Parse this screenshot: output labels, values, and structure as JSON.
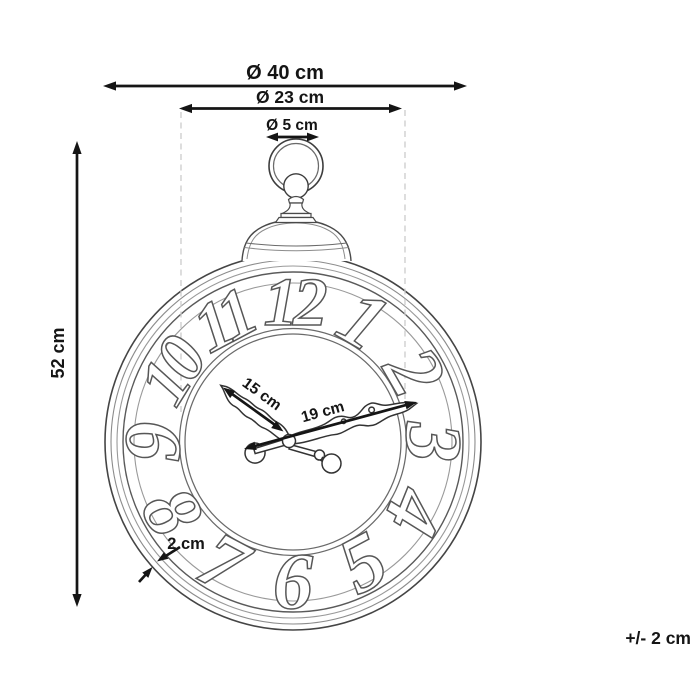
{
  "diagram": {
    "dimensions": {
      "outer_diameter": "Ø 40 cm",
      "dial_diameter": "Ø 23 cm",
      "ring_diameter": "Ø 5 cm",
      "height": "52 cm",
      "short_hand_length": "15 cm",
      "long_hand_length": "19 cm",
      "frame_depth": "2 cm",
      "tolerance": "+/- 2 cm"
    },
    "numerals": [
      "12",
      "1",
      "2",
      "3",
      "4",
      "5",
      "6",
      "7",
      "8",
      "9",
      "10",
      "11"
    ],
    "colors": {
      "ink": "#151515",
      "line_art": "#4a4a4a",
      "dashed_guide": "#cbcbcb",
      "background": "#ffffff"
    }
  }
}
